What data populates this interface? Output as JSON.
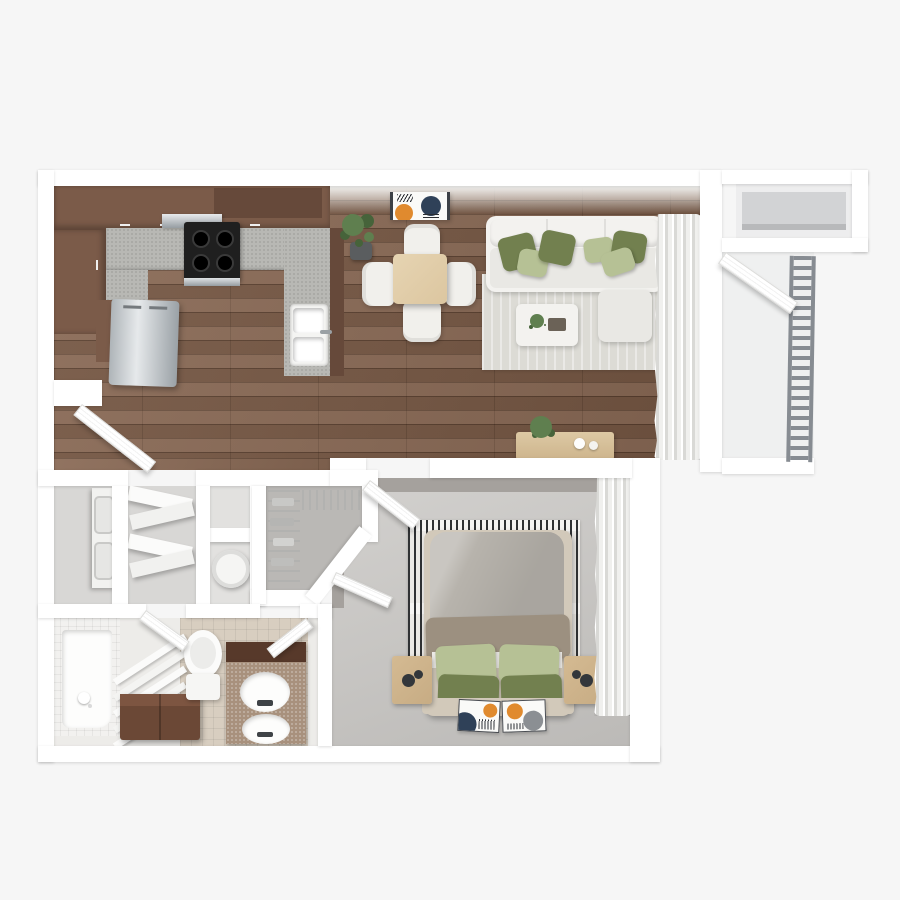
{
  "scene": {
    "title": "3D top-down floor plan of a one-bedroom, one-bathroom apartment with balcony",
    "view": "top-down 3D render",
    "visible_text": "none"
  },
  "rooms": [
    {
      "id": "kitchen",
      "name": "Kitchen"
    },
    {
      "id": "dining",
      "name": "Dining area"
    },
    {
      "id": "living",
      "name": "Living room"
    },
    {
      "id": "balcony",
      "name": "Balcony"
    },
    {
      "id": "balcony-storage",
      "name": "Balcony storage closet"
    },
    {
      "id": "entry",
      "name": "Entry"
    },
    {
      "id": "laundry",
      "name": "Laundry closet"
    },
    {
      "id": "utility",
      "name": "Utility closet with open doors"
    },
    {
      "id": "water-heater",
      "name": "Water heater closet"
    },
    {
      "id": "walk-in-closet",
      "name": "Walk-in closet"
    },
    {
      "id": "bathroom",
      "name": "Bathroom"
    },
    {
      "id": "bedroom",
      "name": "Bedroom"
    }
  ],
  "furniture": {
    "kitchen": [
      "U-shaped brown cabinets",
      "speckled gray countertop",
      "black range with 4 burners",
      "range hood",
      "stainless refrigerator",
      "double-basin sink with faucet",
      "peninsula counter"
    ],
    "dining": [
      "square light-wood dining table",
      "4 white chairs",
      "abstract wall art",
      "potted plant"
    ],
    "living": [
      "white sectional sofa",
      "6 throw pillows (3 olive, 3 sage)",
      "light area rug",
      "white coffee table with plant and tray",
      "ottoman",
      "white curtains",
      "wood console table with plant and bowls"
    ],
    "balcony": [
      "slatted metal railing",
      "balcony door",
      "storage closet with shelf"
    ],
    "entry": [
      "entry door"
    ],
    "laundry": [
      "stacked washer and dryer"
    ],
    "utility": [
      "two open bi-fold door panels"
    ],
    "water-heater": [
      "cylindrical water heater",
      "storage shelf"
    ],
    "walk-in-closet": [
      "wire shelving with folded clothes",
      "hanging rail"
    ],
    "bathroom": [
      "tiled tub/shower with hand shower",
      "slatted screen",
      "dark wood storage bench",
      "toilet",
      "double-sink vanity with dark backsplash",
      "two doors"
    ],
    "bedroom": [
      "queen bed with taupe duvet",
      "4 pillows (2 sage, 2 olive)",
      "striped black-and-white rug",
      "2 wood nightstands",
      "2 abstract art cards on floor",
      "white curtains",
      "door"
    ]
  },
  "counts": {
    "dining_chairs": 4,
    "sofa_pillows": 6,
    "bed_pillows": 4,
    "bathroom_sinks": 2,
    "art_cards": 2,
    "railing_style": "horizontal rungs"
  },
  "palette": {
    "bg": "#f6f6f6",
    "wall": "#ffffff",
    "wallFace": "#f3f3f1",
    "wood": "#82604a",
    "woodSeam": "#55392a",
    "counter": "#b8b8b4",
    "cabinet": "#7b5b49",
    "cabinetDark": "#66493a",
    "stove": "#1f1f1f",
    "stainless": "#c6c9cb",
    "stainlessDark": "#969da2",
    "rugLiving": "#dcdbd5",
    "sofa": "#f3f2ef",
    "sofaSeat": "#e9e8e4",
    "pillowOlive": "#72804f",
    "pillowSage": "#b6c195",
    "tableWood": "#dcc6a0",
    "chairWhite": "#f1f0ec",
    "chairLeg": "#b98d57",
    "consoleWood": "#cdb48c",
    "plant": "#5f7f4f",
    "plantDark": "#46633a",
    "pot": "#5a5d5f",
    "carpet": "#cac8c5",
    "bedroomWallFace": "#a5a19d",
    "rugStripeDark": "#303234",
    "rugStripeLight": "#ebe9e5",
    "mattress": "#b7b3ac",
    "duvet": "#9c9080",
    "sheetWhite": "#edebe7",
    "bedBase": "#d2c9ba",
    "nightstand": "#c7ac84",
    "knobDark": "#33373b",
    "curtain": "#f4f4f2",
    "curtainShade": "#d9d9d6",
    "balconyFloor": "#eff0f0",
    "railing": "#878c92",
    "closetShelf": "#d2d3d5",
    "tileBeige": "#d8cec0",
    "vanityTop": "#a8917d",
    "vanityDark": "#57392a",
    "benchBrown": "#6b4836",
    "benchTop": "#7d5541",
    "bathFloor": "#edece9",
    "tubTile": "#f2f1ef",
    "compFloor": "#d8d7d5",
    "closetFloor": "#bab8b5",
    "wire": "#b2b2b0",
    "artNavy": "#2f4158",
    "artOrange": "#e08a2e",
    "artInk": "#2b2e33"
  }
}
